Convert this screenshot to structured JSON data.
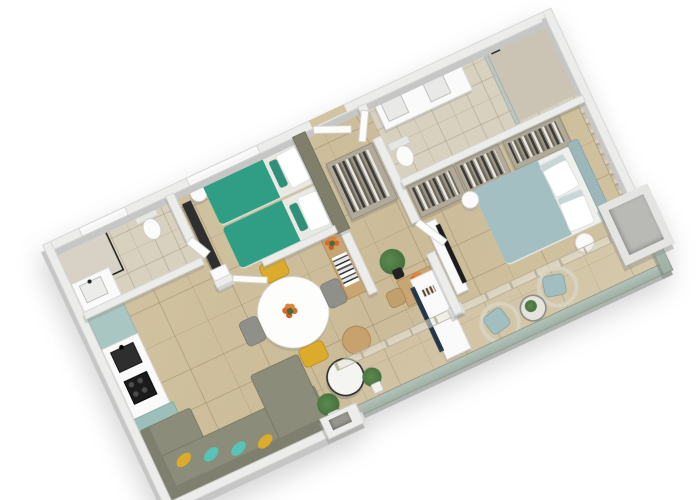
{
  "scene": {
    "type": "3d-floor-plan-render",
    "description": "Isometric 3D floor plan of a two-bedroom apartment with balcony, rotated diagonally on a white background",
    "rotation_deg": -25,
    "background": "#ffffff"
  },
  "palette": {
    "floor": "#d2c3a2",
    "bathFloor": "#d9d1c0",
    "wallFace": "#ececea",
    "wallEdge": "#d2d2d0",
    "wallShadow": "#c6c6c6",
    "wallDark": "#7f7f6c",
    "tealBed": "#2f9e84",
    "mattress": "#eae8e2",
    "blueBed": "#a4bfc2",
    "headboard2": "#9db6ba",
    "mint": "#a9c6c2",
    "mintTall": "#9dbfba",
    "counter": "#f2f1ee",
    "applianceDark": "#1b1b1b",
    "sofa": "#8b8c7a",
    "sofaDark": "#7e7f6e",
    "pillowYellow": "#dcab2c",
    "pillowTeal": "#56c4b8",
    "woodLight": "#c9a671",
    "white": "#fafafa",
    "tvDark": "#1a2430",
    "wicker": "#d8d2c1",
    "cushionBlue": "#a2bec0",
    "balustrade": "#b3c3ba",
    "plantGreen": "#46703f",
    "flowersOrange": "#d86a2a",
    "wardrobe": "#b1aa9b",
    "wallpaper": "#c3b8a2"
  },
  "rooms": [
    {
      "id": "bathroom-1",
      "furniture": [
        "walk-in shower with black glass frame",
        "toilet",
        "vanity with sink",
        "window"
      ]
    },
    {
      "id": "bedroom-1",
      "furniture": [
        "twin beds with teal runners",
        "white and green pillows",
        "olive headboard wall",
        "TV panel with dresser",
        "round side table",
        "window"
      ]
    },
    {
      "id": "entry-hall",
      "furniture": [
        "entry door",
        "open closet with hanging clothes"
      ]
    },
    {
      "id": "ensuite-bathroom",
      "furniture": [
        "double vanity with two sinks",
        "two mirrors",
        "toilet",
        "walk-in shower"
      ]
    },
    {
      "id": "walk-in-closet",
      "furniture": [
        "two open wardrobes with clothes"
      ]
    },
    {
      "id": "bedroom-2",
      "furniture": [
        "double bed with light blue duvet",
        "white pillows",
        "patterned wallpaper wall",
        "wardrobe with clothes",
        "two round side tables",
        "TV partition",
        "glass wall to balcony"
      ]
    },
    {
      "id": "kitchen",
      "furniture": [
        "mint cabinets",
        "white counter",
        "black sink",
        "black cooktop",
        "tall mint unit"
      ]
    },
    {
      "id": "dining-area",
      "furniture": [
        "round white table",
        "orange flower centerpiece",
        "two yellow chairs",
        "two grey chairs",
        "wood console with books and flowers",
        "small desk with chair and flowers",
        "potted palm"
      ]
    },
    {
      "id": "living-room",
      "furniture": [
        "L-shaped olive sofa",
        "yellow and teal pillows",
        "white coffee table",
        "wood coffee table",
        "potted plant",
        "white TV console with TV",
        "sliding glass door"
      ]
    },
    {
      "id": "balcony",
      "furniture": [
        "two rattan armchairs with blue cushions",
        "round glass table with plant",
        "small palm",
        "glass balustrade",
        "structural column"
      ]
    }
  ]
}
